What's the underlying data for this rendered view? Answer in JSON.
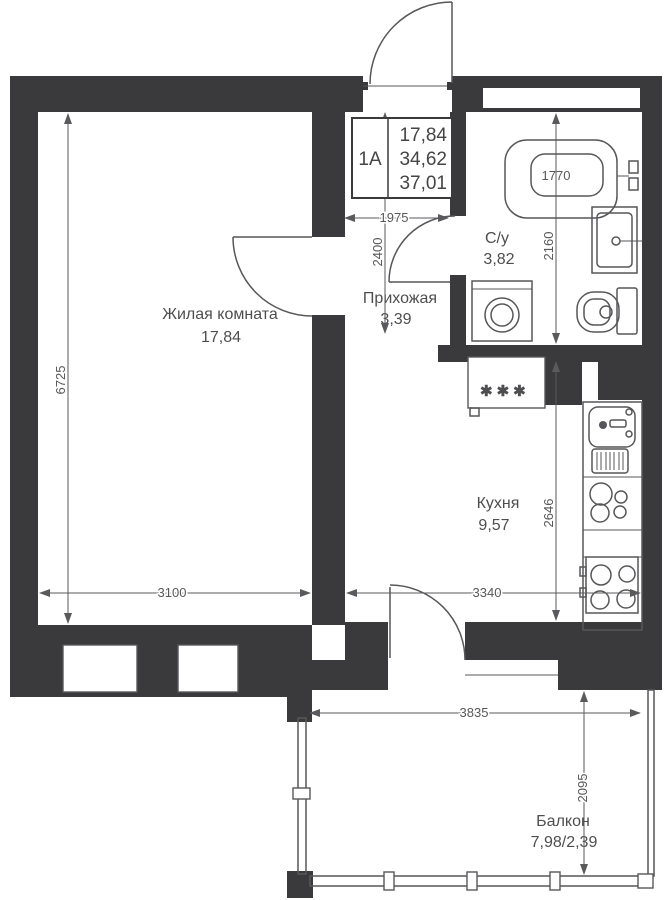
{
  "title_block": {
    "unit": "1А",
    "living_area": "17,84",
    "usable_area": "34,62",
    "total_area": "37,01"
  },
  "rooms": {
    "living": {
      "name": "Жилая комната",
      "area": "17,84"
    },
    "hallway": {
      "name": "Прихожая",
      "area": "3,39"
    },
    "bathroom": {
      "name": "С/у",
      "area": "3,82"
    },
    "kitchen": {
      "name": "Кухня",
      "area": "9,57"
    },
    "balcony": {
      "name": "Балкон",
      "area": "7,98/2,39"
    }
  },
  "dimensions": {
    "hallway_width": "1975",
    "hallway_depth": "2400",
    "bathroom_depth": "2160",
    "bathtub_length": "1770",
    "living_depth": "6725",
    "living_width": "3100",
    "kitchen_width": "3340",
    "kitchen_depth": "2646",
    "balcony_width": "3835",
    "balcony_depth": "2095"
  },
  "symbols": {
    "refrigerator": "✱✱✱"
  },
  "colors": {
    "wall": "#3a3a3c",
    "line": "#57575a",
    "text": "#4e4e50",
    "dim_text": "#58585a",
    "background": "#ffffff"
  }
}
